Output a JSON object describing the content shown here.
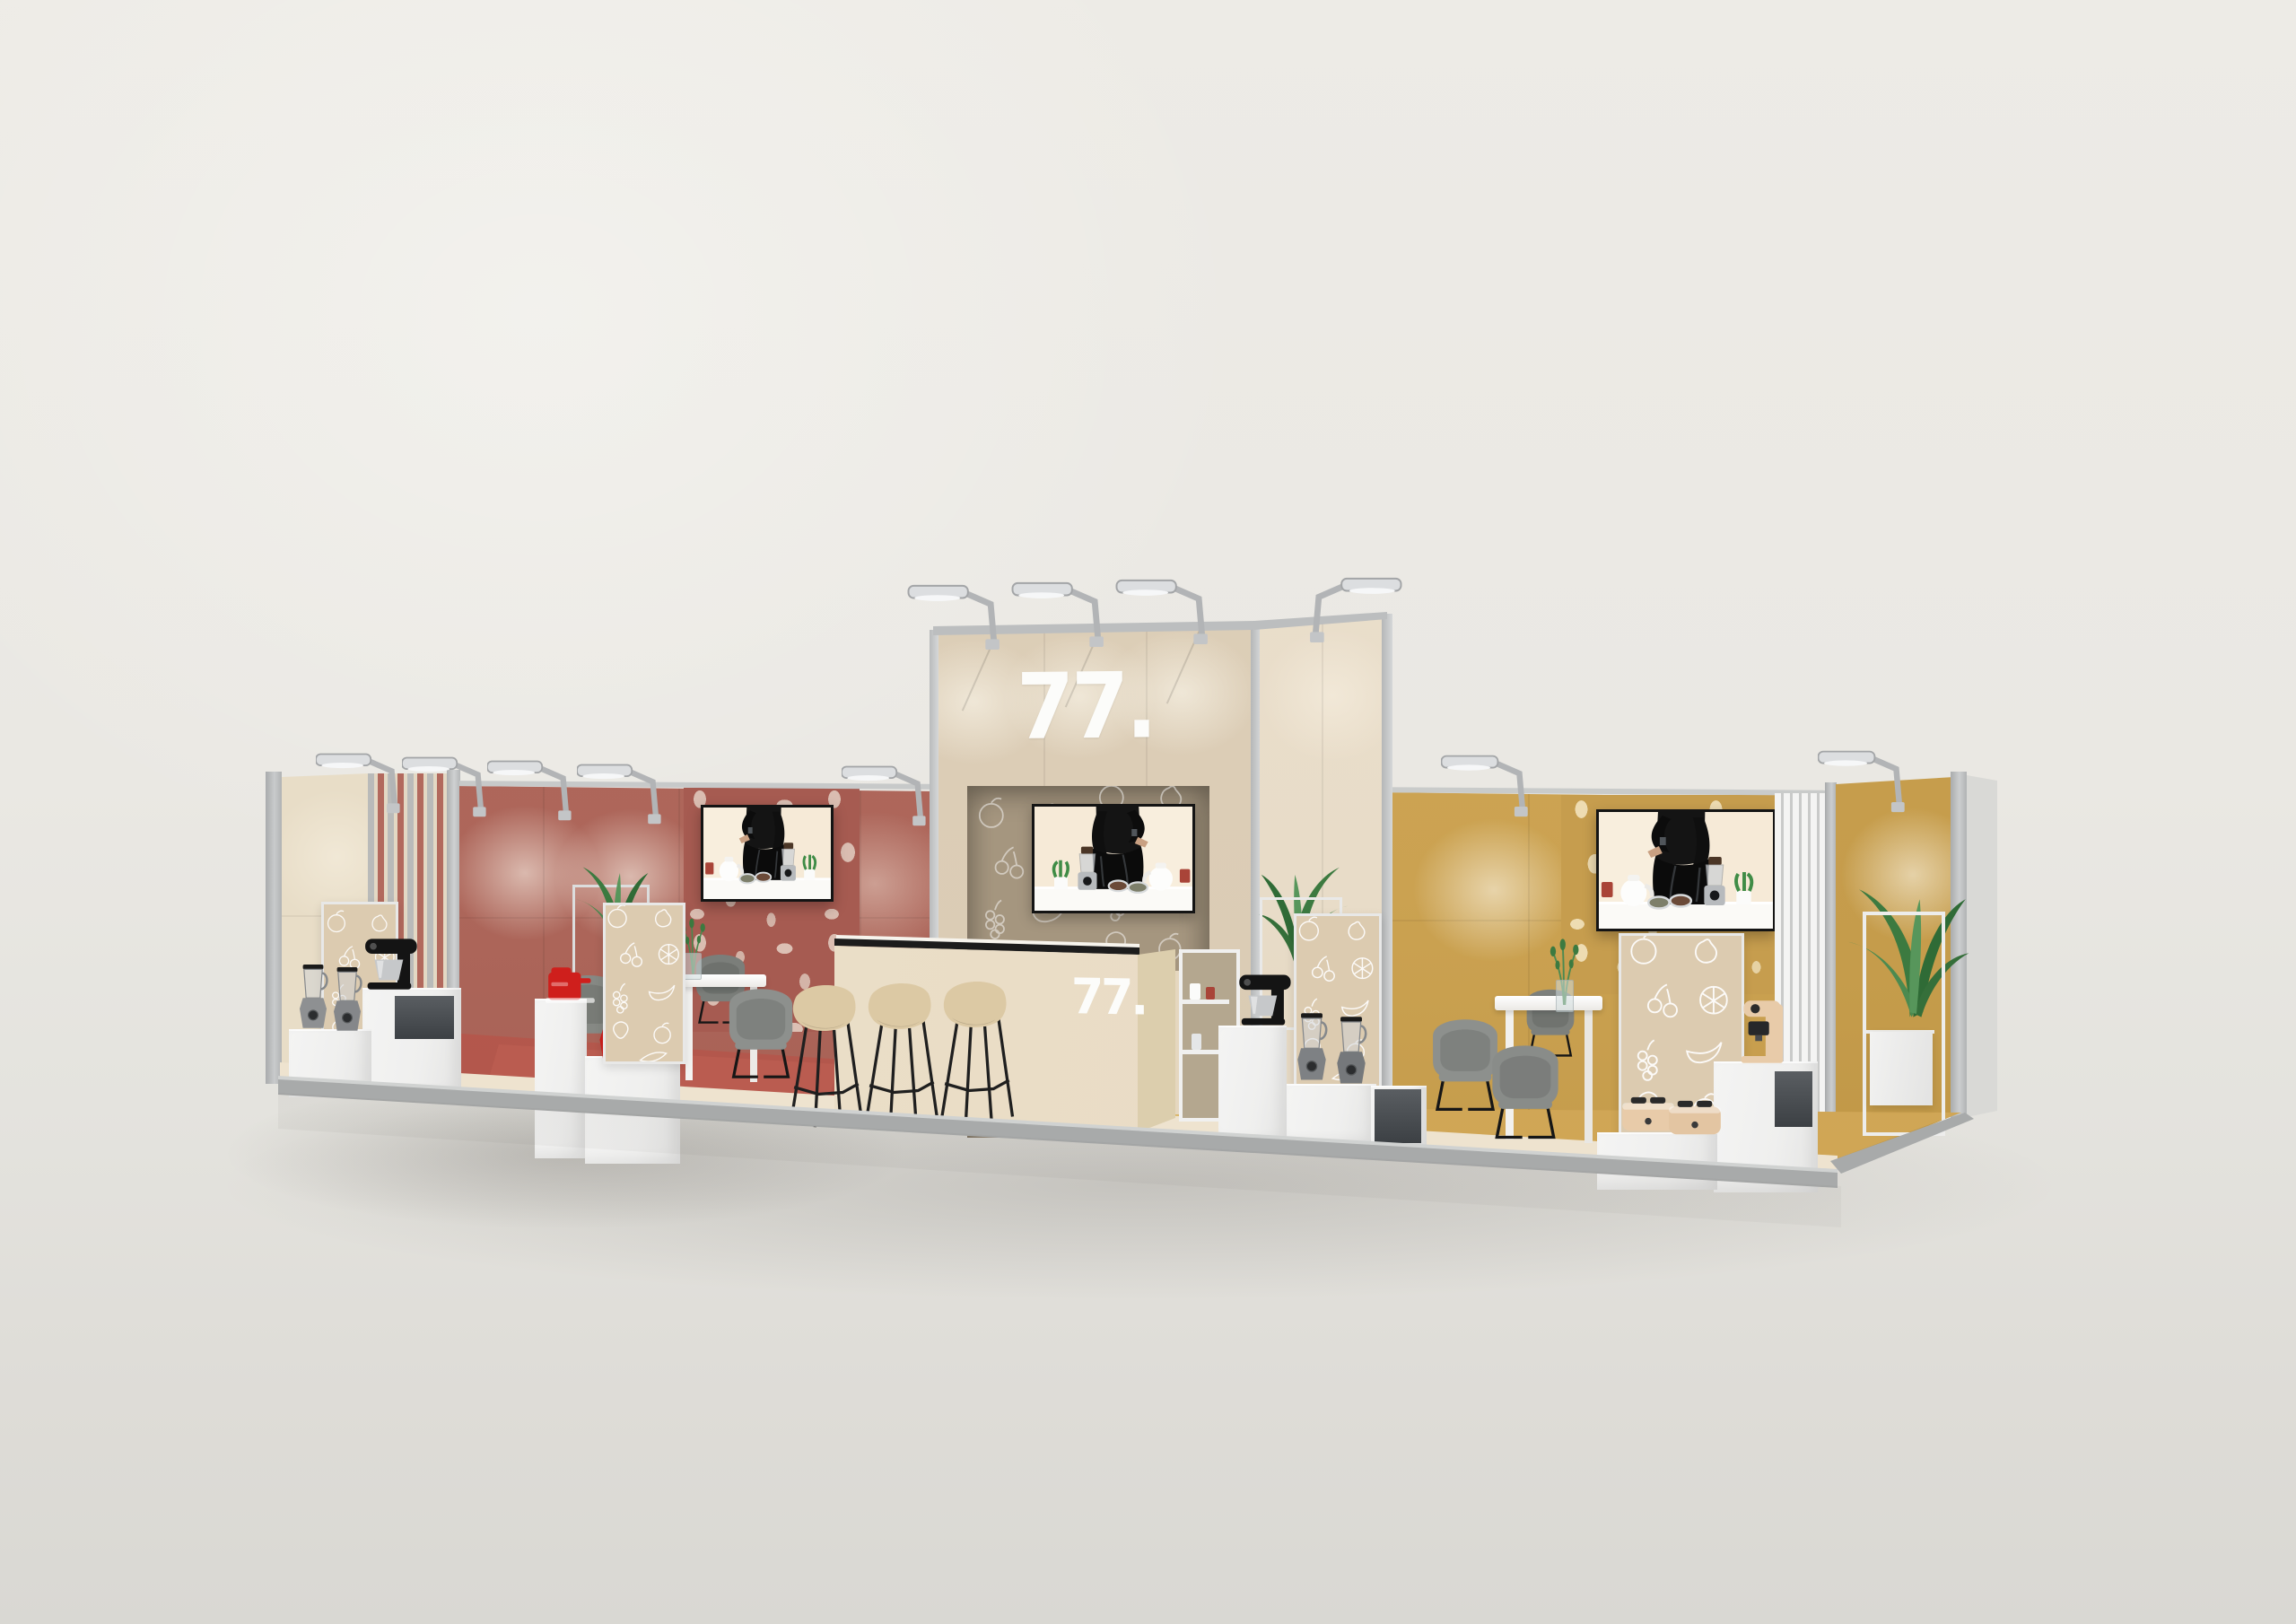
{
  "scene": {
    "subject": "3D render of a modular exhibition booth with kitchen-appliance displays",
    "stand_sign_tower": "77.",
    "stand_sign_counter": "77."
  },
  "palette": {
    "backdrop": "#ebe9e4",
    "ground": "#dddcd7",
    "frame_silver": "#b9bbbc",
    "wall_cream": "#e8ddc7",
    "wall_red": "#b0695d",
    "red_terrazzo_speckle": "#dabdb1",
    "wall_gold": "#cfa757",
    "gold_terrazzo_speckle": "#eedcb2",
    "tower_beige": "#dccdb6",
    "tower_side": "#e9decb",
    "recess_taupe": "#a5967f",
    "doodle_panel": "#dccbb0",
    "counter_beige": "#e9dcc5",
    "cube_white": "#f1f1f0",
    "stool_beige": "#dcc9a4",
    "chair_gray": "#8d908d",
    "rug_red": "#b5584c",
    "floor_gold": "#d0a655",
    "floor_cream": "#ece1cd",
    "appliance_red": "#cf1f1c",
    "appliance_black": "#141414",
    "appliance_silver": "#8e9092",
    "appliance_cream": "#e8cba9",
    "plant_green": "#3c7a40",
    "tv_screen_bg": "#f6ead7"
  }
}
